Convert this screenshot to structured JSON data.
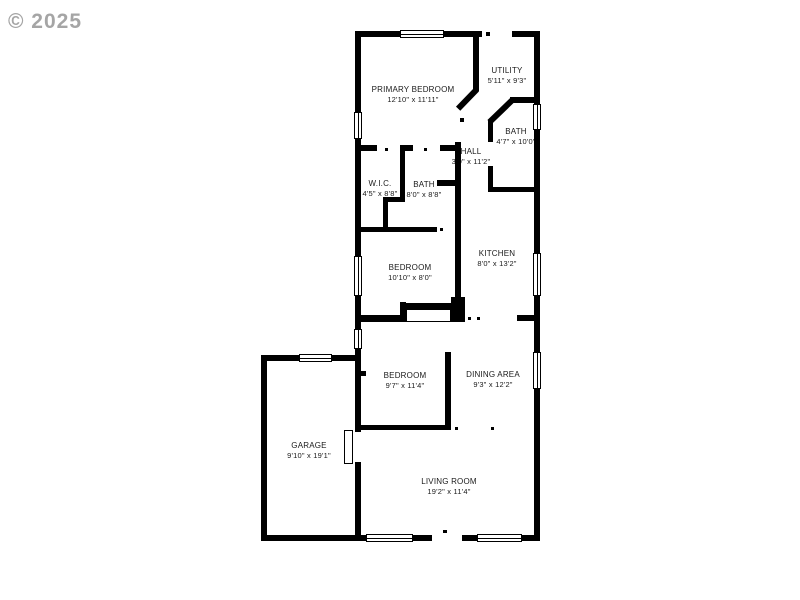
{
  "watermark": "© 2025",
  "rooms": [
    {
      "name": "PRIMARY BEDROOM",
      "dims": "12'10\" x 11'11\""
    },
    {
      "name": "UTILITY",
      "dims": "5'11\" x 9'3\""
    },
    {
      "name": "BATH",
      "dims": "4'7\" x 10'0\""
    },
    {
      "name": "HALL",
      "dims": "3'0\" x 11'2\""
    },
    {
      "name": "W.I.C.",
      "dims": "4'5\" x 8'8\""
    },
    {
      "name": "BATH",
      "dims": "8'0\" x 8'8\""
    },
    {
      "name": "KITCHEN",
      "dims": "8'0\" x 13'2\""
    },
    {
      "name": "BEDROOM",
      "dims": "10'10\" x 8'0\""
    },
    {
      "name": "BEDROOM",
      "dims": "9'7\" x 11'4\""
    },
    {
      "name": "DINING AREA",
      "dims": "9'3\" x 12'2\""
    },
    {
      "name": "GARAGE",
      "dims": "9'10\" x 19'1\""
    },
    {
      "name": "LIVING ROOM",
      "dims": "19'2\" x 11'4\""
    }
  ],
  "colors": {
    "wall": "#000000",
    "background": "#ffffff",
    "watermark": "#8f8f8f"
  }
}
